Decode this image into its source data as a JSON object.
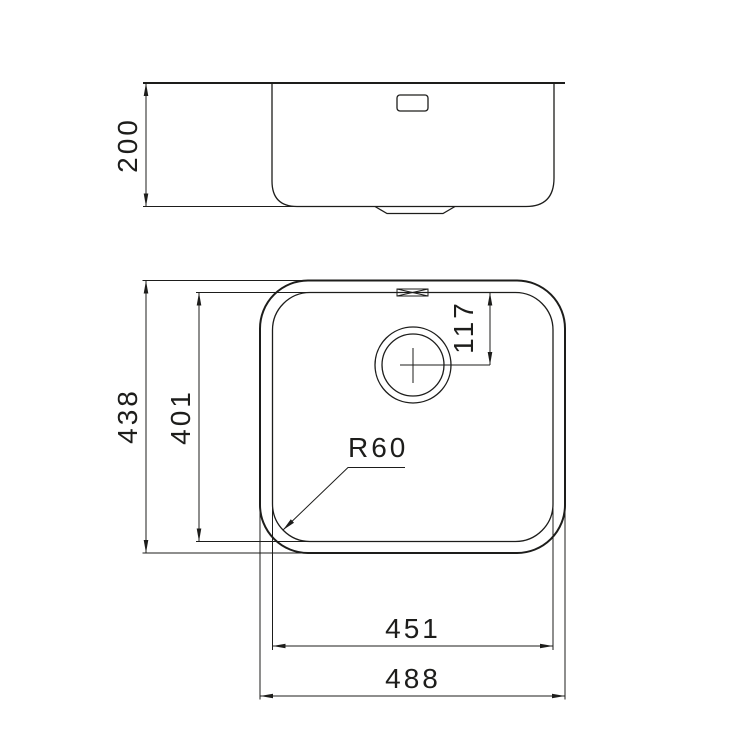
{
  "drawing": {
    "type": "technical-dimension-drawing",
    "subject": "undermount sink, side elevation and plan view",
    "line_color": "#1d1d1b",
    "background_color": "#ffffff"
  },
  "side_view": {
    "name": "side-elevation",
    "dims": {
      "depth": "200"
    }
  },
  "front_view": {
    "name": "plan-view",
    "dims": {
      "overall_height": "438",
      "bowl_height": "401",
      "drain_center_from_top": "117",
      "corner_radius": "R60",
      "bowl_width": "451",
      "overall_width": "488"
    }
  }
}
